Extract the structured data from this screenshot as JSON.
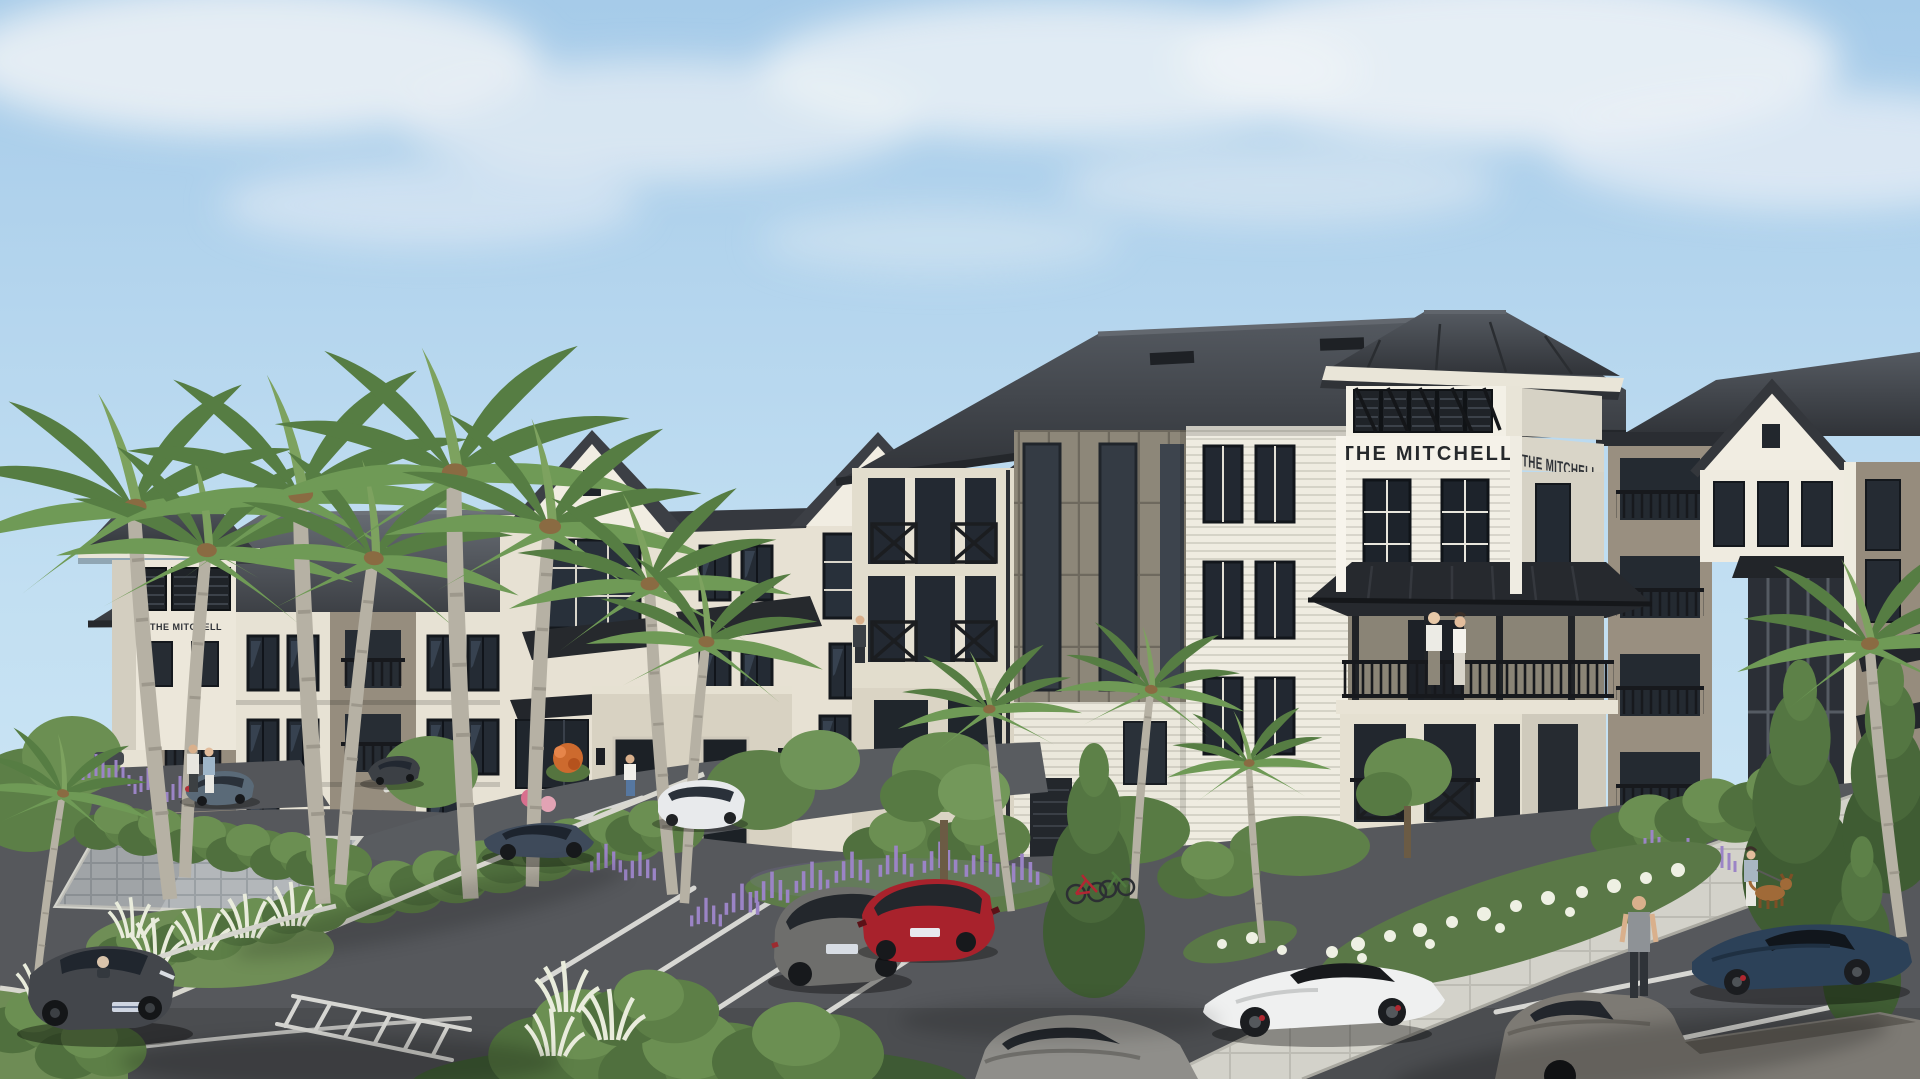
{
  "signage": {
    "tower_front": "THE MITCHELL",
    "tower_side": "THE MITCHELL",
    "left_tower": "THE MITCHELL"
  },
  "palette": {
    "sky_top": "#a6cbe9",
    "sky_horizon": "#d3eaf6",
    "cloud": "#eef2f6",
    "roof_dark": "#3d4046",
    "roof_metal": "#26292e",
    "wall_cream": "#e7e2d4",
    "wall_white": "#f2efe5",
    "wall_taupe": "#968d7e",
    "stone": "#dad4c4",
    "window_glass": "#232a33",
    "railing_black": "#17191d",
    "foliage_green": "#5d7f47",
    "palm_green": "#6f9a56",
    "lavender": "#9b84c6",
    "white_bloom": "#eef0e3",
    "asphalt": "#56585c",
    "sidewalk": "#d3d2ca",
    "paver_plaza": "#b3b7ba",
    "lane_marking": "#e3e3df",
    "car_dark_gray": "#43464b",
    "car_blue_gray_wagon": "#5a6a78",
    "car_blue_sedan": "#3e4a5a",
    "car_white_compact": "#e8eaec",
    "car_suv_gray": "#6e6e6c",
    "car_red": "#a8222c",
    "car_sedan_gray": "#8f8e8a",
    "car_white_sports": "#eff0f0",
    "car_navy_sports": "#2c4158",
    "truck_gray": "#7d7a74",
    "dog_brown": "#a06a38"
  },
  "scene": {
    "setting": "Four-story coastal-style apartment community with dark hip roofs, white and taupe siding, black balcony railings, a signed cupola tower, royal palms and a landscaped parking lot under a partly cloudy sky",
    "vehicles": [
      {
        "type": "sedan",
        "color": "dark gray",
        "location": "front-left stall, driver inside"
      },
      {
        "type": "wagon",
        "color": "blue-gray",
        "location": "far-left lot by palms"
      },
      {
        "type": "sedan",
        "color": "dark gray",
        "location": "upper-left drive"
      },
      {
        "type": "sedan",
        "color": "blue",
        "location": "entry drive"
      },
      {
        "type": "compact",
        "color": "white",
        "location": "entrance drop-off"
      },
      {
        "type": "suv wagon",
        "color": "gray",
        "location": "center stalls"
      },
      {
        "type": "sedan",
        "color": "red",
        "location": "center stalls"
      },
      {
        "type": "sedan",
        "color": "gray",
        "location": "bottom center, partly out of frame"
      },
      {
        "type": "sports coupe",
        "color": "white",
        "location": "driving lane center-right"
      },
      {
        "type": "sports coupe",
        "color": "navy",
        "location": "right stalls"
      },
      {
        "type": "pickup truck",
        "color": "gray",
        "location": "bottom right, partly out of frame"
      }
    ],
    "people": [
      {
        "who": "couple",
        "where": "tower balcony"
      },
      {
        "who": "resident",
        "where": "mid-building balcony"
      },
      {
        "who": "couple walking",
        "where": "left drive"
      },
      {
        "who": "pedestrian",
        "where": "entrance walkway"
      },
      {
        "who": "man walking",
        "where": "right sidewalk"
      },
      {
        "who": "woman walking a dog",
        "where": "right sidewalk"
      }
    ],
    "bicycles": {
      "count": 2,
      "location": "planting bed right of center"
    }
  }
}
